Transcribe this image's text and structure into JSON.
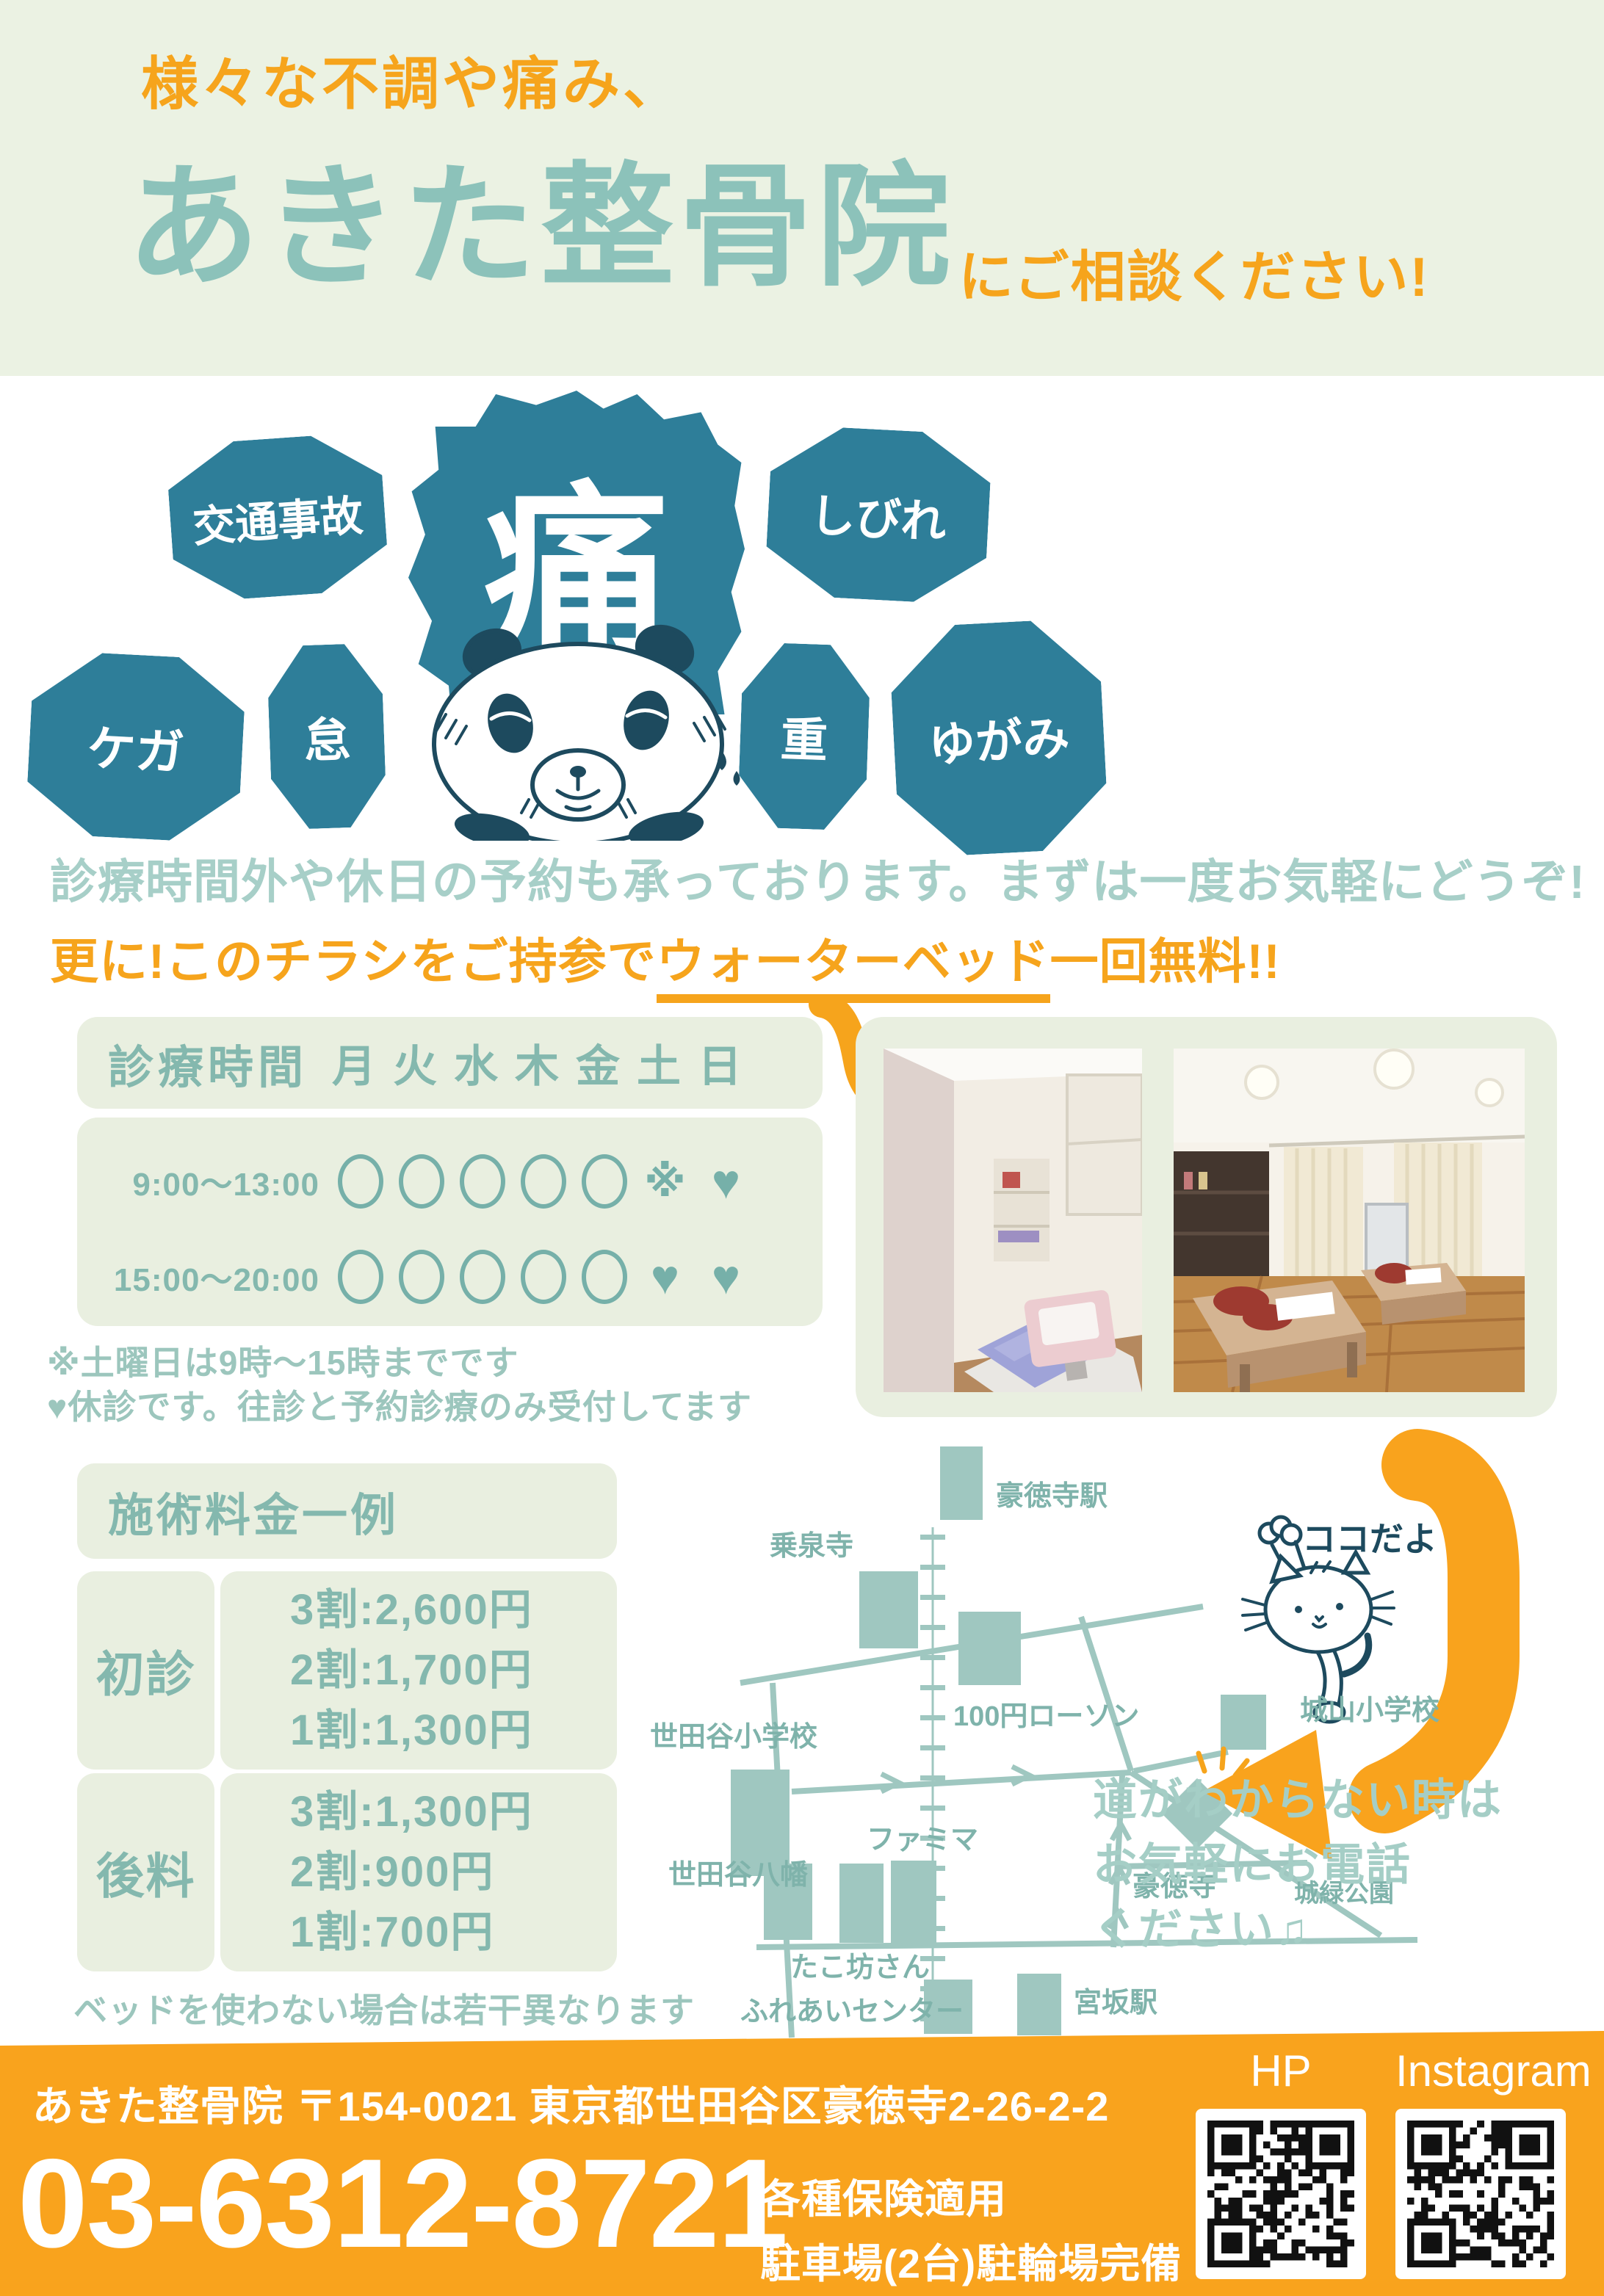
{
  "colors": {
    "accent_orange": "#f6a41c",
    "footer_orange": "#f9a31d",
    "badge_teal": "#2e7e99",
    "title_teal": "#8cc2ba",
    "text_teal": "#84b8ae",
    "soft_teal": "#a7cfc8",
    "map_teal": "#9fc7c0",
    "map_label_teal": "#7fb3ab",
    "ink_navy": "#1d4a5e",
    "panel_green": "#e9efe0",
    "header_green": "#ebf2e3"
  },
  "header": {
    "tagline": "様々な不調や痛み、",
    "clinic_name": "あきた整骨院",
    "consult_suffix": "にご相談ください!"
  },
  "badges": {
    "pain": "痛",
    "traffic_accident": "交通事故",
    "numbness": "しびれ",
    "injury": "ケガ",
    "dullness": "怠",
    "heaviness": "重",
    "distortion": "ゆがみ"
  },
  "intro": {
    "line1": "診療時間外や休日の予約も承っております。まずは一度お気軽にどうぞ!",
    "line2_prefix": "更に!このチラシをご持参で",
    "line2_underline": "ウォーターベッド",
    "line2_suffix": "一回無料!!"
  },
  "schedule": {
    "title": "診療時間",
    "days": [
      "月",
      "火",
      "水",
      "木",
      "金",
      "土",
      "日"
    ],
    "kome_char": "※",
    "heart_char": "♥",
    "rows": [
      {
        "time": "9:00〜13:00",
        "marks": [
          "circle",
          "circle",
          "circle",
          "circle",
          "circle",
          "kome",
          "heart"
        ]
      },
      {
        "time": "15:00〜20:00",
        "marks": [
          "circle",
          "circle",
          "circle",
          "circle",
          "circle",
          "heart",
          "heart"
        ]
      }
    ],
    "note1": "※土曜日は9時〜15時までです",
    "note2": "♥休診です。往診と予約診療のみ受付してます"
  },
  "pricing": {
    "title": "施術料金一例",
    "rows": [
      {
        "label": "初診",
        "lines": [
          "3割:2,600円",
          "2割:1,700円",
          "1割:1,300円"
        ]
      },
      {
        "label": "後料",
        "lines": [
          "3割:1,300円",
          "2割:900円",
          "1割:700円"
        ]
      }
    ],
    "note": "ベッドを使わない場合は若干異なります"
  },
  "map": {
    "labels": {
      "gotokuji_station": "豪徳寺駅",
      "josenji": "乗泉寺",
      "lawson": "100円ローソン",
      "setagaya_elementary": "世田谷小学校",
      "shiroyama_elementary": "城山小学校",
      "famima": "ファミマ",
      "setagaya_hachiman": "世田谷八幡",
      "takobo": "たこ坊さん",
      "fureai_center": "ふれあいセンター",
      "miyasaka_station": "宮坂駅",
      "gotokuji": "豪徳寺",
      "shiroku_park": "城緑公園"
    },
    "koko": "ココだよ",
    "help_lines": [
      "道がわからない時は",
      "お気軽にお電話",
      "ください♫"
    ]
  },
  "footer": {
    "address": "あきた整骨院 〒154-0021 東京都世田谷区豪徳寺2-26-2-2",
    "phone": "03-6312-8721",
    "note1": "各種保険適用",
    "note2": "駐車場(2台)駐輪場完備",
    "hp_label": "HP",
    "instagram_label": "Instagram"
  }
}
